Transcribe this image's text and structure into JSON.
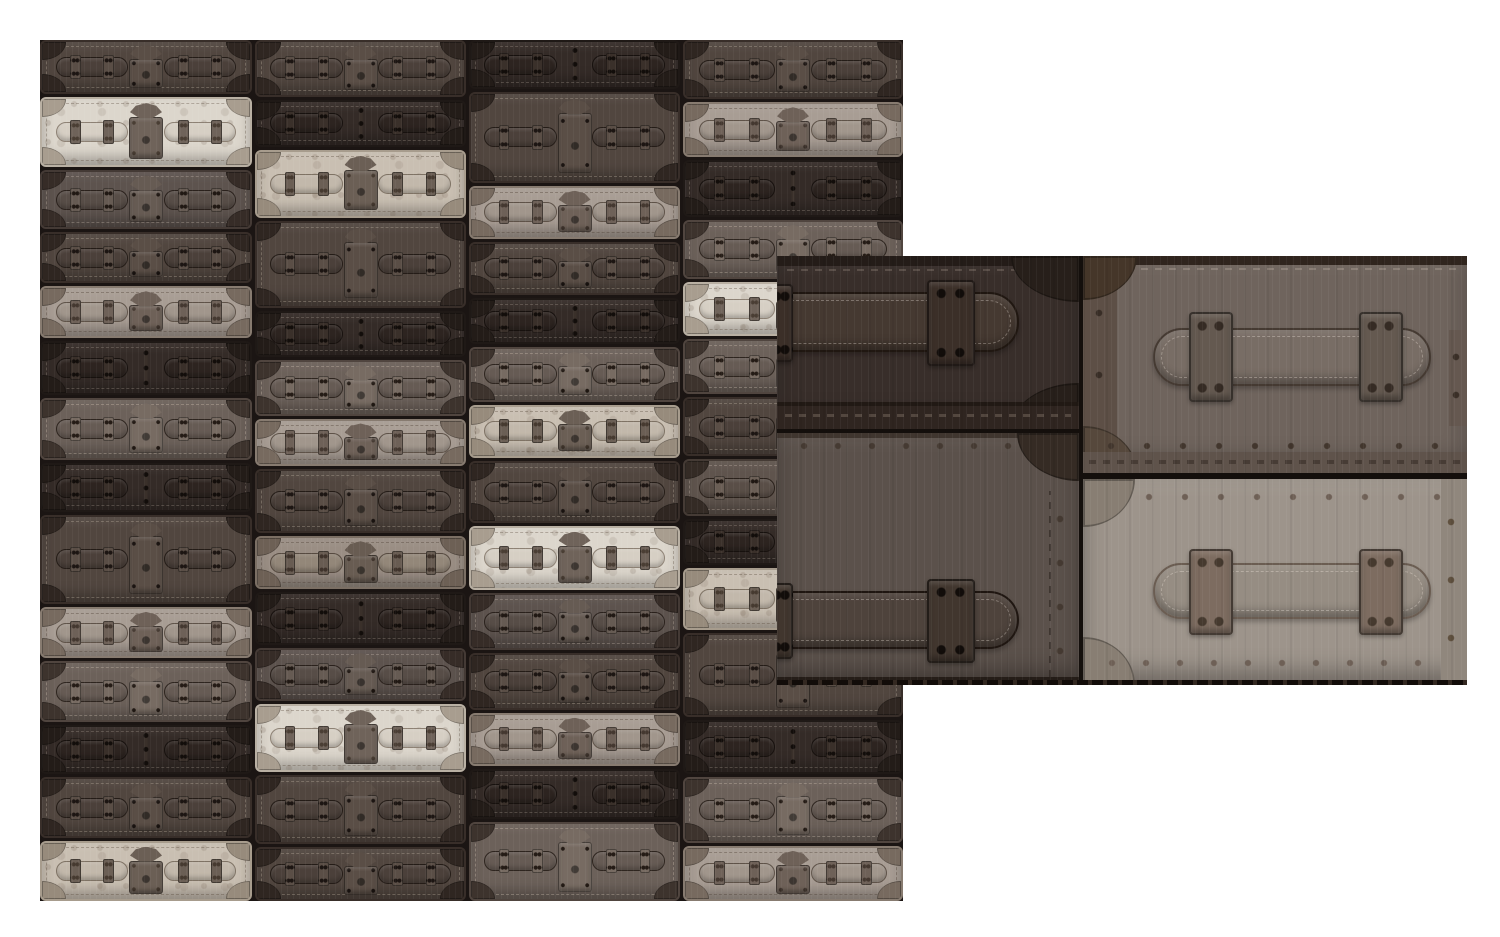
{
  "canvas": {
    "width": 1500,
    "height": 937,
    "background": "#ffffff"
  },
  "palette": {
    "vd": {
      "body": "#342b27",
      "rim": "#1f1916",
      "ln": "#17110e",
      "hand": "#2d2420",
      "hw": "#3a302a",
      "cap": "#231c18",
      "stc": "rgba(190,175,160,.28)",
      "rv": "#120d0a"
    },
    "d1": {
      "body": "#5d534e",
      "rim": "#443a35",
      "ln": "#2a211c",
      "hand": "#574d47",
      "hw": "#665b53",
      "cap": "#362c27",
      "stc": "rgba(215,200,185,.30)",
      "rv": "#201813"
    },
    "d2": {
      "body": "#51463f",
      "rim": "#382e29",
      "ln": "#241c17",
      "hand": "#4b403a",
      "hw": "#5a4e46",
      "cap": "#2f2621",
      "stc": "rgba(210,195,178,.30)",
      "rv": "#1c1512"
    },
    "md": {
      "body": "#6c615a",
      "rim": "#50453f",
      "ln": "#2e251f",
      "hand": "#665b54",
      "hw": "#776b62",
      "cap": "#3d332d",
      "stc": "rgba(220,205,190,.32)",
      "rv": "#241b15"
    },
    "mdk": {
      "body": "#5f544d",
      "rim": "#453b35",
      "ln": "#2a211b",
      "hand": "#594e47",
      "hw": "#6a5e55",
      "cap": "#342b25",
      "stc": "rgba(215,200,185,.30)",
      "rv": "#1f1712"
    },
    "lt": {
      "body": "#a89d94",
      "rim": "#877b70",
      "ln": "#5e5248",
      "hand": "#a1968c",
      "hw": "#6e6158",
      "cap": "#776a5f",
      "stc": "rgba(70,55,45,.35)",
      "rv": "#443830"
    },
    "lt2": {
      "body": "#9a8e84",
      "rim": "#7b6f64",
      "ln": "#564a40",
      "hand": "#938779",
      "hw": "#685c52",
      "cap": "#6d6055",
      "stc": "rgba(70,55,45,.35)",
      "rv": "#3f332b"
    },
    "cr": {
      "body": "#dcd6cc",
      "rim": "#b9b0a3",
      "ln": "#8d8174",
      "hand": "#d6cfc4",
      "hw": "#6f635a",
      "cap": "#a89d8f",
      "stc": "rgba(90,75,60,.35)",
      "rv": "#4a3e34",
      "speck": true
    },
    "cm": {
      "body": "#c9bfb2",
      "rim": "#a79c8d",
      "ln": "#7e7264",
      "hand": "#c2b8ab",
      "hw": "#6b5f55",
      "cap": "#978b7c",
      "stc": "rgba(85,70,55,.35)",
      "rv": "#463a30",
      "speck": true
    }
  },
  "pattern": {
    "x": 40,
    "y": 40,
    "width": 863,
    "height": 861,
    "gap": 3,
    "gap_color": "#1b1513",
    "columns": [
      {
        "w": 212,
        "cases": [
          {
            "v": "d2",
            "lock": true,
            "h": 53
          },
          {
            "v": "cr",
            "lock": true,
            "h": 70
          },
          {
            "v": "d1",
            "lock": true,
            "h": 58
          },
          {
            "v": "d2",
            "lock": true,
            "h": 50
          },
          {
            "v": "lt",
            "lock": true,
            "h": 50
          },
          {
            "v": "vd",
            "lock": false,
            "h": 53
          },
          {
            "v": "md",
            "lock": true,
            "h": 62
          },
          {
            "v": "vd",
            "lock": false,
            "h": 47
          },
          {
            "v": "d2",
            "lock": true,
            "h": 90
          },
          {
            "v": "lt",
            "lock": true,
            "h": 50
          },
          {
            "v": "md",
            "lock": true,
            "h": 60
          },
          {
            "v": "vd",
            "lock": false,
            "h": 48
          },
          {
            "v": "d2",
            "lock": true,
            "h": 60
          },
          {
            "v": "cm",
            "lock": true,
            "h": 59
          }
        ]
      },
      {
        "w": 211,
        "cases": [
          {
            "v": "d2",
            "lock": true,
            "h": 56
          },
          {
            "v": "vd",
            "lock": false,
            "h": 46
          },
          {
            "v": "cm",
            "lock": true,
            "h": 68
          },
          {
            "v": "d2",
            "lock": true,
            "h": 88
          },
          {
            "v": "vd",
            "lock": false,
            "h": 45
          },
          {
            "v": "md",
            "lock": true,
            "h": 55
          },
          {
            "v": "lt",
            "lock": true,
            "h": 46
          },
          {
            "v": "d2",
            "lock": true,
            "h": 64
          },
          {
            "v": "lt2",
            "lock": true,
            "h": 52
          },
          {
            "v": "vd",
            "lock": false,
            "h": 52
          },
          {
            "v": "d1",
            "lock": true,
            "h": 52
          },
          {
            "v": "cr",
            "lock": true,
            "h": 68
          },
          {
            "v": "d2",
            "lock": true,
            "h": 69
          },
          {
            "v": "d2",
            "lock": true,
            "h": 53
          }
        ]
      },
      {
        "w": 211,
        "cases": [
          {
            "v": "vd",
            "lock": false,
            "h": 48
          },
          {
            "v": "d2",
            "lock": true,
            "h": 92
          },
          {
            "v": "lt",
            "lock": true,
            "h": 52
          },
          {
            "v": "d2",
            "lock": true,
            "h": 52
          },
          {
            "v": "vd",
            "lock": false,
            "h": 45
          },
          {
            "v": "md",
            "lock": true,
            "h": 54
          },
          {
            "v": "cm",
            "lock": true,
            "h": 52
          },
          {
            "v": "d2",
            "lock": true,
            "h": 62
          },
          {
            "v": "cr",
            "lock": true,
            "h": 64
          },
          {
            "v": "d1",
            "lock": true,
            "h": 56
          },
          {
            "v": "d2",
            "lock": true,
            "h": 56
          },
          {
            "v": "lt",
            "lock": true,
            "h": 52
          },
          {
            "v": "vd",
            "lock": false,
            "h": 49
          },
          {
            "v": "md",
            "lock": true,
            "h": 80
          }
        ]
      },
      {
        "w": 220,
        "cases": [
          {
            "v": "d2",
            "lock": true,
            "h": 55
          },
          {
            "v": "lt",
            "lock": true,
            "h": 51
          },
          {
            "v": "vd",
            "lock": false,
            "h": 52
          },
          {
            "v": "md",
            "lock": true,
            "h": 55
          },
          {
            "v": "cr",
            "lock": true,
            "h": 50
          },
          {
            "v": "md",
            "lock": true,
            "h": 51
          },
          {
            "v": "d2",
            "lock": true,
            "h": 55
          },
          {
            "v": "mdk",
            "lock": true,
            "h": 52
          },
          {
            "v": "vd",
            "lock": false,
            "h": 42
          },
          {
            "v": "cm",
            "lock": true,
            "h": 58
          },
          {
            "v": "d2",
            "lock": true,
            "h": 80
          },
          {
            "v": "vd",
            "lock": false,
            "h": 49
          },
          {
            "v": "md",
            "lock": true,
            "h": 62
          },
          {
            "v": "lt",
            "lock": true,
            "h": 51
          }
        ]
      }
    ]
  },
  "inset": {
    "x": 777,
    "y": 256,
    "width": 690,
    "height": 429,
    "gap_color": "#140f0c",
    "trunks": [
      {
        "name": "trunk-top-left",
        "x": 0,
        "y": 0,
        "w": 302,
        "h": 173,
        "body": "#382e2a",
        "kids": [
          {
            "k": "band",
            "x": 0,
            "y": 0,
            "w": 302,
            "h": 10,
            "c": "#241c18"
          },
          {
            "k": "dash",
            "x": 10,
            "y": 13,
            "w": 282,
            "h": 2,
            "c": "rgba(200,185,170,.22)"
          },
          {
            "k": "cap",
            "corner": "tr",
            "x": 234,
            "y": 0,
            "w": 68,
            "h": 46,
            "c": "#271f1a"
          },
          {
            "k": "cap",
            "corner": "br",
            "x": 234,
            "y": 127,
            "w": 68,
            "h": 46,
            "c": "#271f1a"
          },
          {
            "k": "strap",
            "x": -10,
            "y": 36,
            "w": 252,
            "h": 60,
            "c": "#453931",
            "ln": "#201711",
            "tip": "right"
          },
          {
            "k": "keeper",
            "x": -8,
            "y": 28,
            "w": 24,
            "h": 78,
            "c": "#3b2f28",
            "rv": "#120d0a"
          },
          {
            "k": "keeper",
            "x": 150,
            "y": 24,
            "w": 48,
            "h": 86,
            "c": "#3b2f28",
            "rv": "#120d0a"
          },
          {
            "k": "band",
            "x": 0,
            "y": 146,
            "w": 302,
            "h": 4,
            "c": "#211914"
          },
          {
            "k": "band",
            "x": 0,
            "y": 150,
            "w": 302,
            "h": 23,
            "c": "#2f2520"
          },
          {
            "k": "dash",
            "x": 8,
            "y": 158,
            "w": 286,
            "h": 3,
            "c": "rgba(190,172,155,.25)"
          }
        ]
      },
      {
        "name": "trunk-bottom-left",
        "x": 0,
        "y": 177,
        "w": 302,
        "h": 252,
        "body": "#5b514b",
        "kids": [
          {
            "k": "band",
            "x": 0,
            "y": 0,
            "w": 302,
            "h": 5,
            "c": "#40362f"
          },
          {
            "k": "dots",
            "x": 10,
            "y": 9,
            "w": 284,
            "h": 8,
            "c": "#453a32",
            "sx": 34
          },
          {
            "k": "cap",
            "corner": "tr",
            "x": 240,
            "y": 0,
            "w": 62,
            "h": 48,
            "c": "#352b24"
          },
          {
            "k": "vdash",
            "x": 272,
            "y": 58,
            "w": 2,
            "h": 186,
            "c": "rgba(28,20,16,.45)"
          },
          {
            "k": "vdots",
            "x": 279,
            "y": 64,
            "w": 8,
            "h": 174,
            "c": "#443931",
            "sy": 44
          },
          {
            "k": "strap",
            "x": -10,
            "y": 158,
            "w": 252,
            "h": 58,
            "c": "#4e433c",
            "ln": "#1f1611",
            "tip": "right"
          },
          {
            "k": "keeper",
            "x": -8,
            "y": 150,
            "w": 24,
            "h": 76,
            "c": "#41362e",
            "rv": "#120d0a"
          },
          {
            "k": "keeper",
            "x": 150,
            "y": 146,
            "w": 48,
            "h": 84,
            "c": "#41362e",
            "rv": "#120d0a"
          },
          {
            "k": "band",
            "x": 0,
            "y": 244,
            "w": 302,
            "h": 8,
            "c": "#251d18"
          }
        ]
      },
      {
        "name": "trunk-top-right",
        "x": 306,
        "y": 0,
        "w": 384,
        "h": 217,
        "body": "#6f645d",
        "kids": [
          {
            "k": "band",
            "x": 0,
            "y": 0,
            "w": 384,
            "h": 9,
            "c": "#30251e"
          },
          {
            "k": "dash",
            "x": 44,
            "y": 12,
            "w": 332,
            "h": 2,
            "c": "rgba(215,200,185,.25)"
          },
          {
            "k": "band",
            "x": 0,
            "y": 0,
            "w": 34,
            "h": 217,
            "c": "#5d4f46"
          },
          {
            "k": "vdots",
            "x": 11,
            "y": 26,
            "w": 10,
            "h": 168,
            "c": "#382d26",
            "sy": 62
          },
          {
            "k": "cap",
            "corner": "tl",
            "x": 0,
            "y": 0,
            "w": 54,
            "h": 44,
            "c": "#453629"
          },
          {
            "k": "cap",
            "corner": "bl",
            "x": 0,
            "y": 170,
            "w": 54,
            "h": 47,
            "c": "#56483c"
          },
          {
            "k": "strap",
            "x": 70,
            "y": 72,
            "w": 278,
            "h": 58,
            "c": "#786d65",
            "ln": "#453a32",
            "tip": "both"
          },
          {
            "k": "keeper",
            "x": 106,
            "y": 56,
            "w": 44,
            "h": 90,
            "c": "#645950",
            "rv": "#352b24"
          },
          {
            "k": "keeper",
            "x": 276,
            "y": 56,
            "w": 44,
            "h": 90,
            "c": "#645950",
            "rv": "#352b24"
          },
          {
            "k": "band",
            "x": 366,
            "y": 74,
            "w": 18,
            "h": 96,
            "c": "#655850"
          },
          {
            "k": "vdots",
            "x": 368,
            "y": 82,
            "w": 10,
            "h": 80,
            "c": "#3a2f27",
            "sy": 38
          },
          {
            "k": "dots",
            "x": 10,
            "y": 186,
            "w": 366,
            "h": 8,
            "c": "#42362d",
            "sx": 36
          },
          {
            "k": "band",
            "x": 0,
            "y": 196,
            "w": 384,
            "h": 21,
            "c": "#5f534b"
          },
          {
            "k": "dash",
            "x": 6,
            "y": 204,
            "w": 372,
            "h": 4,
            "c": "rgba(35,26,20,.4)"
          }
        ]
      },
      {
        "name": "trunk-bottom-right",
        "x": 306,
        "y": 223,
        "w": 384,
        "h": 206,
        "body": "#9d948b",
        "kids": [
          {
            "k": "dots",
            "x": 12,
            "y": 14,
            "w": 360,
            "h": 8,
            "c": "#6e6056",
            "sx": 36
          },
          {
            "k": "cap",
            "corner": "tl",
            "x": 0,
            "y": 0,
            "w": 52,
            "h": 48,
            "c": "#887e73"
          },
          {
            "k": "cap",
            "corner": "bl",
            "x": 0,
            "y": 158,
            "w": 52,
            "h": 48,
            "c": "#887e73"
          },
          {
            "k": "band",
            "x": 358,
            "y": 0,
            "w": 26,
            "h": 206,
            "c": "#90877d"
          },
          {
            "k": "vdots",
            "x": 363,
            "y": 14,
            "w": 10,
            "h": 178,
            "c": "#60513f",
            "sy": 58
          },
          {
            "k": "strap",
            "x": 70,
            "y": 84,
            "w": 278,
            "h": 56,
            "c": "#968d83",
            "ln": "#6b5d52",
            "tip": "both"
          },
          {
            "k": "keeper",
            "x": 106,
            "y": 70,
            "w": 44,
            "h": 86,
            "c": "#7d6c60",
            "rv": "#463a2f"
          },
          {
            "k": "keeper",
            "x": 276,
            "y": 70,
            "w": 44,
            "h": 86,
            "c": "#7d6c60",
            "rv": "#463a2f"
          },
          {
            "k": "dots",
            "x": 12,
            "y": 180,
            "w": 346,
            "h": 8,
            "c": "#6e6056",
            "sx": 34
          }
        ]
      }
    ]
  }
}
